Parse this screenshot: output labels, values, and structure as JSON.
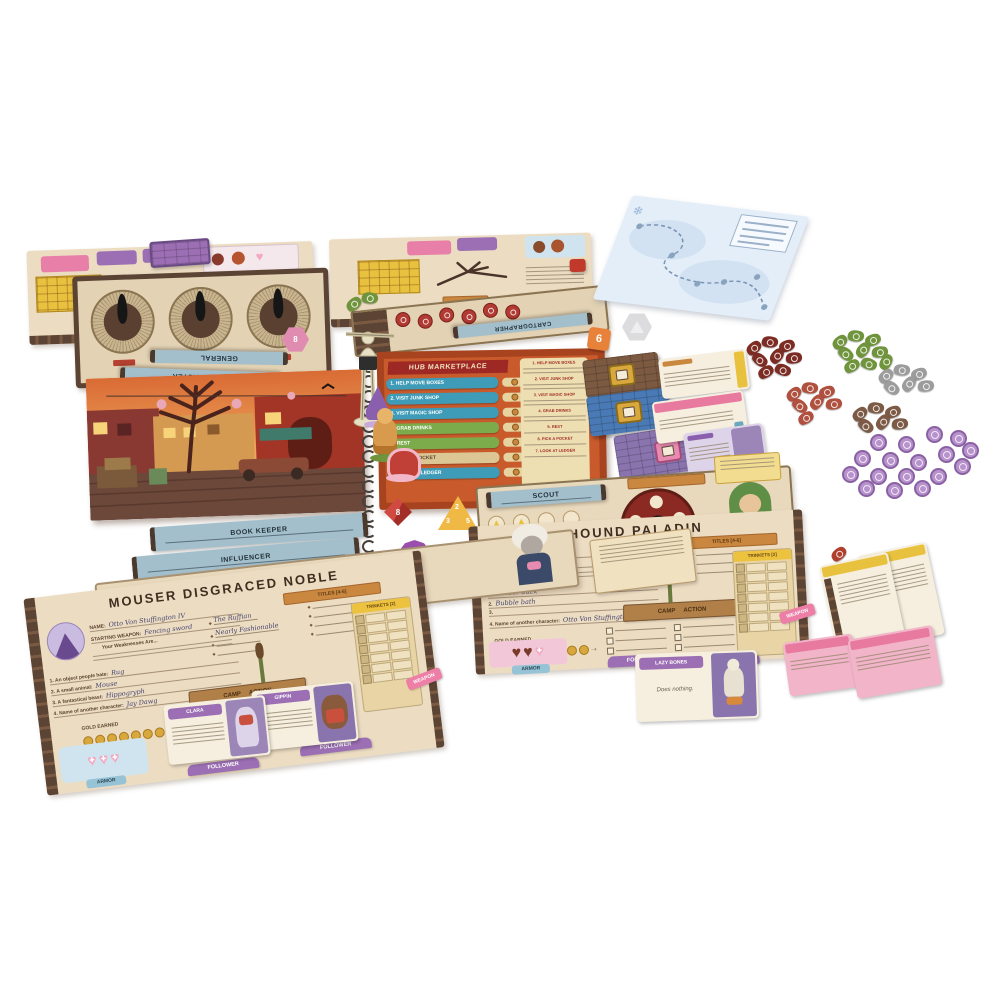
{
  "scene": {
    "background_color": "#ffffff",
    "description": "Tabletop photo of a storybook tabletop game spread: central Hub Marketplace spiral book with standees, four character sheets, dice, cards, and leaf-shaped tokens"
  },
  "icons": {
    "heart": "♥",
    "cross": "✚",
    "crown": "♛",
    "snowflake": "❄",
    "triangle": "▲",
    "diamond": "◆",
    "arrow": "➝"
  },
  "labels": {
    "name": "NAME:",
    "starting_weapon": "STARTING WEAPON:",
    "gold_earned": "GOLD EARNED",
    "camp": "CAMP",
    "action": "ACTION",
    "follower": "FOLLOWER",
    "armor": "ARMOR",
    "weapon": "WEAPON",
    "trinkets": "TRINKETS [2]",
    "titles": "TITLES [4-6]",
    "weaknesses": "Your Weaknesses Are..."
  },
  "book": {
    "title": "HUB MARKETPLACE",
    "menu": [
      {
        "label": "1. HELP MOVE BOXES",
        "color": "#3e9cb8"
      },
      {
        "label": "2. VISIT JUNK SHOP",
        "color": "#3e9cb8"
      },
      {
        "label": "3. VISIT MAGIC SHOP",
        "color": "#3e9cb8"
      },
      {
        "label": "4. GRAB DRINKS",
        "color": "#7cab4c"
      },
      {
        "label": "5. REST",
        "color": "#7cab4c"
      },
      {
        "label": "6. PICK A POCKET",
        "color": "#dcc794"
      },
      {
        "label": "7. LOOK AT LEDGER",
        "color": "#3e9cb8"
      }
    ]
  },
  "nameplates": {
    "general": "GENERAL",
    "game_master": "GAME MASTER",
    "cartographer": "CARTOGRAPHER",
    "book_keeper": "BOOK KEEPER",
    "influencer": "INFLUENCER",
    "scout": "SCOUT"
  },
  "characters": {
    "stilt_kin": {
      "title": "STILT KIN BARBARIAN"
    },
    "goblin_thief": {
      "title": "GOBLIN THIEF"
    },
    "mouser": {
      "title": "MOUSER DISGRACED NOBLE",
      "name_value": "Otto Von Stuffington IV",
      "weapon_value": "Fencing sword",
      "titles_written": [
        "The Ruffian",
        "Nearly Fashionable"
      ],
      "prompts": [
        {
          "label": "1. An object people hate:",
          "value": "Rug"
        },
        {
          "label": "2. A small animal:",
          "value": "Mouse"
        },
        {
          "label": "3. A fantastical beast:",
          "value": "Hippogryph"
        },
        {
          "label": "4. Name of another character:",
          "value": "Jay Dawg"
        }
      ]
    },
    "hound": {
      "title": "HOUND PALADIN",
      "name_value": "Jay Dawg",
      "weapon_value": "",
      "prompts": [
        {
          "label": "1.",
          "value": "Rubber duck"
        },
        {
          "label": "2.",
          "value": "Bubble bath"
        },
        {
          "label": "3.",
          "value": ""
        },
        {
          "label": "4. Name of another character:",
          "value": "Otto Von Stuffington IV"
        }
      ]
    }
  },
  "cards": {
    "clara": {
      "title": "CLARA"
    },
    "gippin": {
      "title": "GIPPIN"
    },
    "lazy_bones": {
      "title": "LAZY BONES",
      "body": "Does nothing."
    }
  },
  "dice": {
    "pink_d20": "8",
    "orange_d6": "6",
    "red_d8": "8",
    "yellow_d4": {
      "top": "2",
      "left": "3",
      "right": "5"
    },
    "purple_d12": "12"
  },
  "tokens": {
    "leaf_clusters": [
      {
        "name": "dark-red-leaves",
        "color": "#7c2c22",
        "count": 8
      },
      {
        "name": "green-leaves",
        "color": "#6f943c",
        "count": 9
      },
      {
        "name": "salmon-leaves",
        "color": "#b0503e",
        "count": 7
      },
      {
        "name": "gray-leaves",
        "color": "#9c9c9c",
        "count": 6
      },
      {
        "name": "brown-leaves",
        "color": "#7c5a45",
        "count": 6
      },
      {
        "name": "green-leaf-pair",
        "color": "#6f943c",
        "count": 2
      },
      {
        "name": "red-leaf-single",
        "color": "#b0402e",
        "count": 1
      }
    ],
    "purple_coins": {
      "color": "#b792cc",
      "count": 17
    },
    "red_round_tokens": {
      "color": "#b13a32",
      "count": 6
    }
  }
}
